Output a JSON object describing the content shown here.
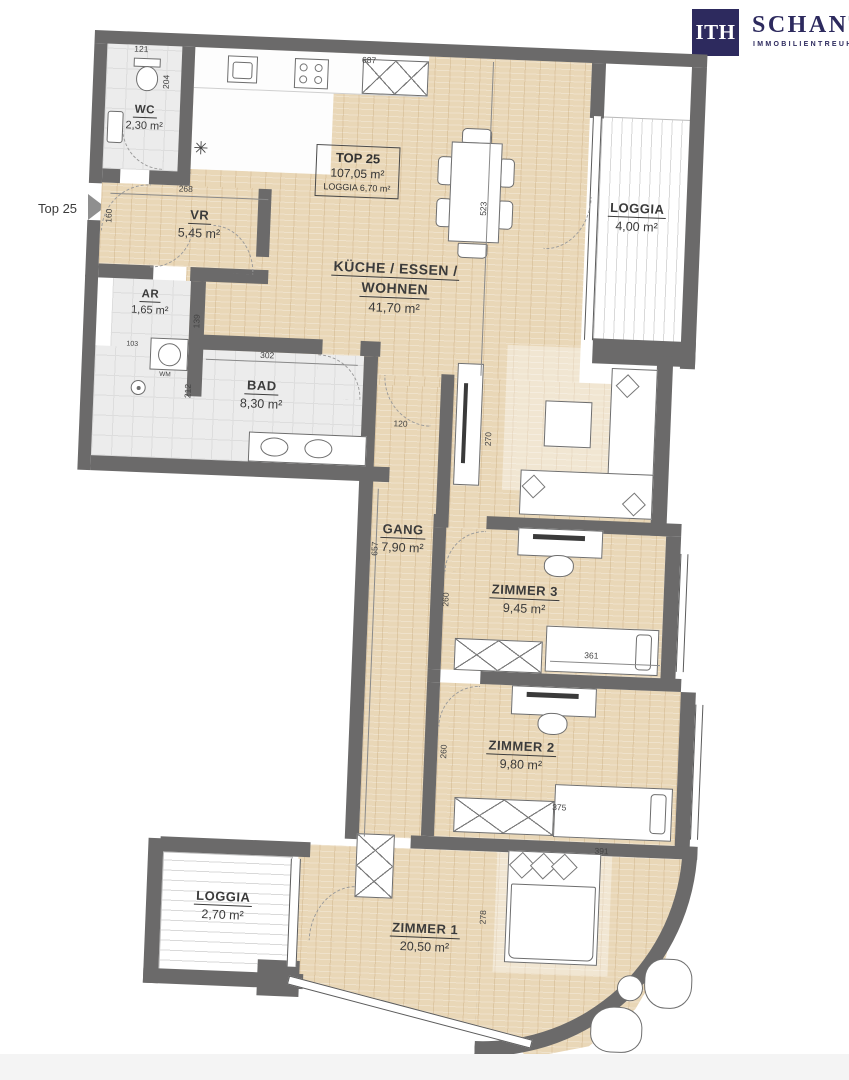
{
  "logo": {
    "monogram": "ITH",
    "name": "SCHANTL",
    "subtitle": "IMMOBILIENTREUHAND"
  },
  "entry_marker": {
    "label": "Top 25"
  },
  "unit_info": {
    "title": "TOP 25",
    "area": "107,05 m²",
    "loggia": "LOGGIA 6,70 m²"
  },
  "rooms": {
    "wc": {
      "name": "WC",
      "area": "2,30 m²"
    },
    "vr": {
      "name": "VR",
      "area": "5,45 m²"
    },
    "ar": {
      "name": "AR",
      "area": "1,65 m²"
    },
    "bad": {
      "name": "BAD",
      "area": "8,30 m²"
    },
    "wohnen": {
      "name_line1": "KÜCHE  / ESSEN /",
      "name_line2": "WOHNEN",
      "area": "41,70 m²"
    },
    "gang": {
      "name": "GANG",
      "area": "7,90 m²"
    },
    "loggia_right": {
      "name": "LOGGIA",
      "area": "4,00 m²"
    },
    "zimmer3": {
      "name": "ZIMMER 3",
      "area": "9,45 m²"
    },
    "zimmer2": {
      "name": "ZIMMER 2",
      "area": "9,80 m²"
    },
    "zimmer1": {
      "name": "ZIMMER 1",
      "area": "20,50 m²"
    },
    "loggia_bottom": {
      "name": "LOGGIA",
      "area": "2,70 m²"
    }
  },
  "annotations": {
    "washing_machine": "WM",
    "fridge_symbol": "✳"
  },
  "dimensions_cm": {
    "wc_width": "121",
    "wc_depth": "204",
    "kitchen_run": "687",
    "living_height": "523",
    "vr_width": "268",
    "entry_width": "160",
    "ar_depth": "139",
    "ar_width": "103",
    "bad_width": "302",
    "bad_depth": "212",
    "gang_door": "120",
    "living_right": "270",
    "gang_length": "657",
    "z3_depth": "260",
    "z3_width": "361",
    "z2_depth": "260",
    "z2_width": "375",
    "z1_width": "391",
    "z1_depth": "278"
  },
  "colors": {
    "wall": "#6b6a6a",
    "wood_floor": "#e9d7b7",
    "tile_floor": "#ececec",
    "brand_navy": "#2d2a5e",
    "background": "#ffffff"
  }
}
